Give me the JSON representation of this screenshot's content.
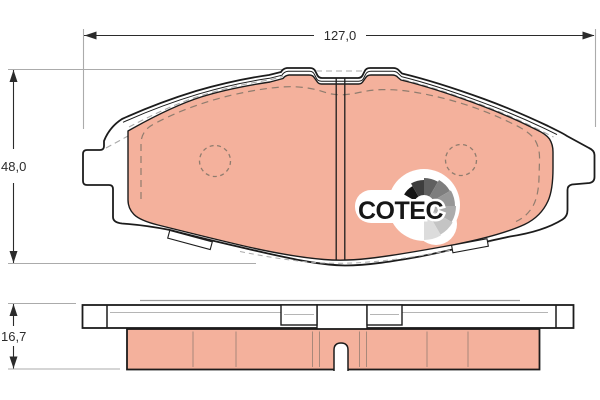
{
  "title": "brake-pad-technical-drawing",
  "dimensions": {
    "width_label": "127,0",
    "height_label": "48,0",
    "thickness_label": "16,7"
  },
  "logo": {
    "text": "COTEC"
  },
  "colors": {
    "friction": "#f4b19c",
    "outline": "#1c1c1c",
    "dim_gray": "#ababab",
    "chamfer": "#8f7c6e",
    "white": "#ffffff"
  }
}
